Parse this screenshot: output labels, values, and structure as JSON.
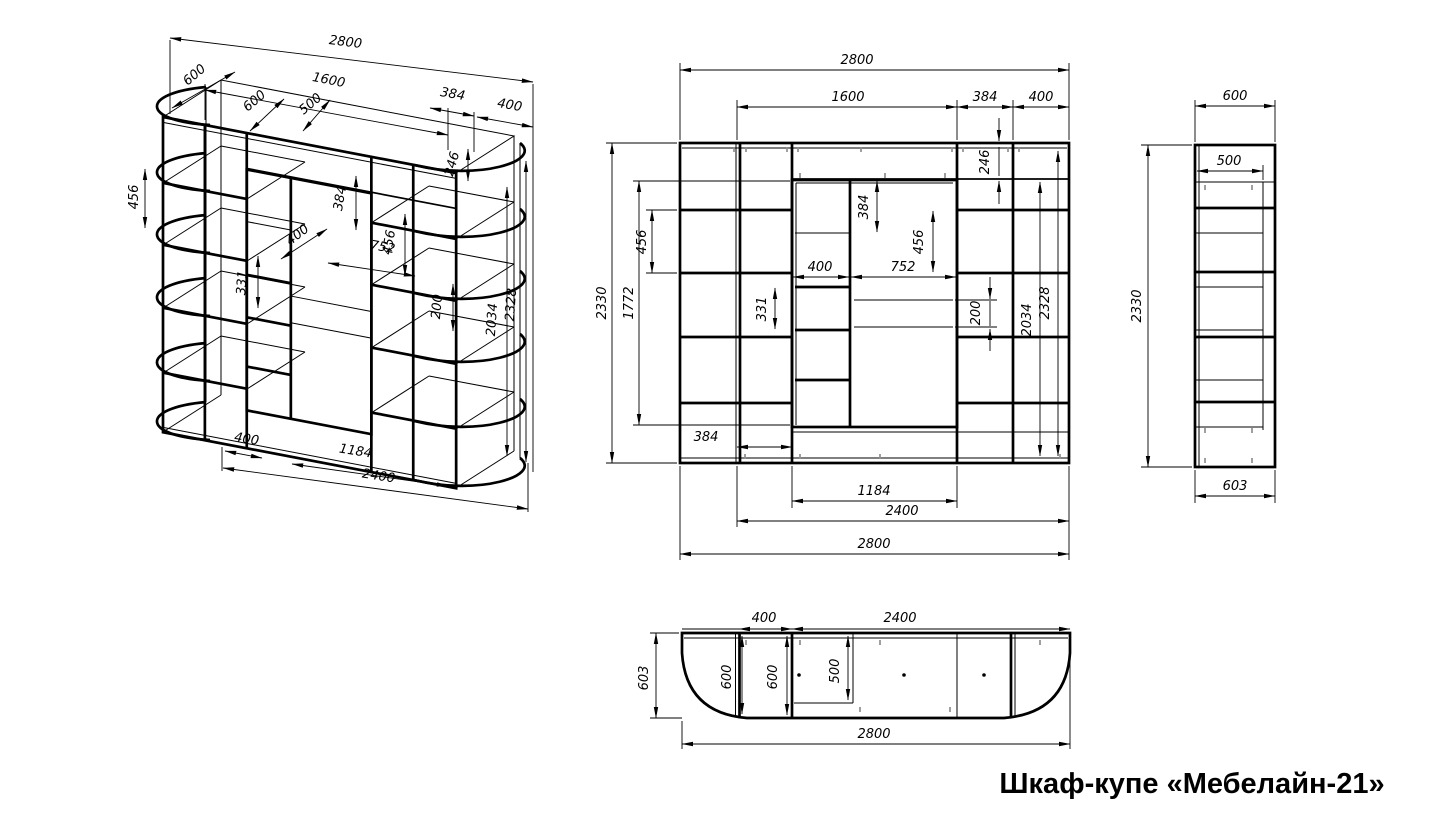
{
  "title": "Шкаф-купе «Мебелайн-21»",
  "views": {
    "iso": {
      "w2800": "2800",
      "d600a": "600",
      "w1600": "1600",
      "d600b": "600",
      "d500": "500",
      "w384": "384",
      "w400": "400",
      "h456": "456",
      "h384": "384",
      "h456b": "456",
      "w752": "752",
      "d400": "400",
      "h331": "331",
      "h200": "200",
      "h246": "246",
      "h2034": "2034",
      "h2328": "2328",
      "b400": "400",
      "b1184": "1184",
      "b2400": "2400"
    },
    "front": {
      "t2800": "2800",
      "t1600": "1600",
      "t384": "384",
      "t400": "400",
      "l2330": "2330",
      "l1772": "1772",
      "l456": "456",
      "i246": "246",
      "i384": "384",
      "i456": "456",
      "i400": "400",
      "i752": "752",
      "i331": "331",
      "i200": "200",
      "r2034": "2034",
      "r2328": "2328",
      "b384": "384",
      "b1184": "1184",
      "b2400": "2400",
      "b2800": "2800"
    },
    "side": {
      "t600": "600",
      "i500": "500",
      "l2330": "2330",
      "b603": "603"
    },
    "plan": {
      "t400": "400",
      "t2400": "2400",
      "l603": "603",
      "i600a": "600",
      "i600b": "600",
      "i500": "500",
      "b2800": "2800"
    }
  }
}
